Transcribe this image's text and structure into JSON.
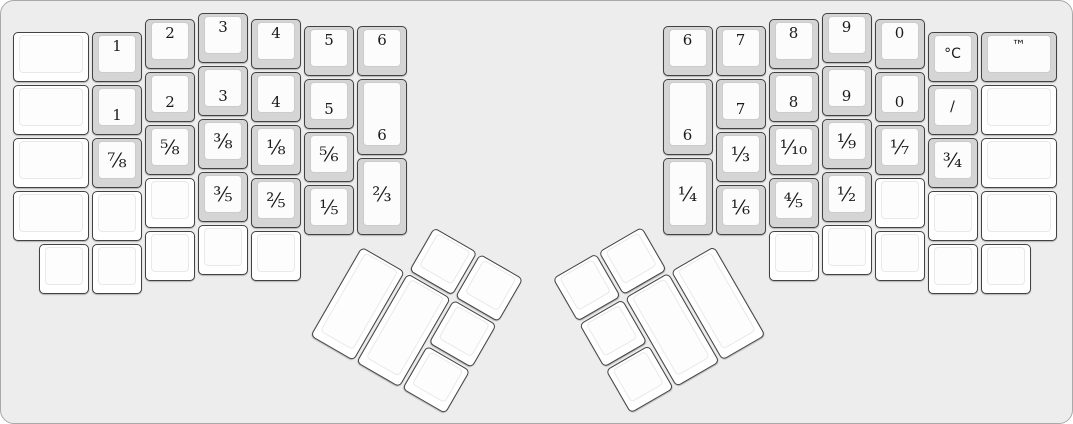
{
  "board": {
    "width_px": 1073,
    "height_px": 424,
    "unit_px": 53,
    "background_color": "#ededed",
    "outline_color": "#a9a9a9"
  },
  "key_style": {
    "labeled_base_color": "#d5d5d5",
    "blank_base_color": "#ffffff",
    "cap_top_color": "#fcfcfc",
    "key_outline_color": "#424242",
    "legend_color": "#1a1a1a"
  },
  "left_half": {
    "origin_px": [
      10,
      10
    ],
    "main_keys": [
      {
        "label": "",
        "x": 0,
        "y": 0.375,
        "w": 1.5,
        "h": 1,
        "pos": "c"
      },
      {
        "label": "",
        "x": 0,
        "y": 1.375,
        "w": 1.5,
        "h": 1,
        "pos": "c"
      },
      {
        "label": "",
        "x": 0,
        "y": 2.375,
        "w": 1.5,
        "h": 1,
        "pos": "c"
      },
      {
        "label": "",
        "x": 0,
        "y": 3.375,
        "w": 1.5,
        "h": 1,
        "pos": "c"
      },
      {
        "label": "",
        "x": 0.5,
        "y": 4.375,
        "w": 1,
        "h": 1,
        "pos": "c"
      },
      {
        "label": "1",
        "x": 1.5,
        "y": 0.375,
        "w": 1,
        "h": 1,
        "pos": "t"
      },
      {
        "label": "1",
        "x": 1.5,
        "y": 1.375,
        "w": 1,
        "h": 1,
        "pos": "b"
      },
      {
        "label": "⅞",
        "x": 1.5,
        "y": 2.375,
        "w": 1,
        "h": 1,
        "pos": "c"
      },
      {
        "label": "",
        "x": 1.5,
        "y": 3.375,
        "w": 1,
        "h": 1,
        "pos": "c"
      },
      {
        "label": "",
        "x": 1.5,
        "y": 4.375,
        "w": 1,
        "h": 1,
        "pos": "c"
      },
      {
        "label": "2",
        "x": 2.5,
        "y": 0.125,
        "w": 1,
        "h": 1,
        "pos": "t"
      },
      {
        "label": "2",
        "x": 2.5,
        "y": 1.125,
        "w": 1,
        "h": 1,
        "pos": "b"
      },
      {
        "label": "⅝",
        "x": 2.5,
        "y": 2.125,
        "w": 1,
        "h": 1,
        "pos": "c"
      },
      {
        "label": "",
        "x": 2.5,
        "y": 3.125,
        "w": 1,
        "h": 1,
        "pos": "c"
      },
      {
        "label": "",
        "x": 2.5,
        "y": 4.125,
        "w": 1,
        "h": 1,
        "pos": "c"
      },
      {
        "label": "3",
        "x": 3.5,
        "y": 0,
        "w": 1,
        "h": 1,
        "pos": "t"
      },
      {
        "label": "3",
        "x": 3.5,
        "y": 1,
        "w": 1,
        "h": 1,
        "pos": "b"
      },
      {
        "label": "⅜",
        "x": 3.5,
        "y": 2,
        "w": 1,
        "h": 1,
        "pos": "c"
      },
      {
        "label": "⅗",
        "x": 3.5,
        "y": 3,
        "w": 1,
        "h": 1,
        "pos": "c"
      },
      {
        "label": "",
        "x": 3.5,
        "y": 4,
        "w": 1,
        "h": 1,
        "pos": "c"
      },
      {
        "label": "4",
        "x": 4.5,
        "y": 0.125,
        "w": 1,
        "h": 1,
        "pos": "t"
      },
      {
        "label": "4",
        "x": 4.5,
        "y": 1.125,
        "w": 1,
        "h": 1,
        "pos": "b"
      },
      {
        "label": "⅛",
        "x": 4.5,
        "y": 2.125,
        "w": 1,
        "h": 1,
        "pos": "c"
      },
      {
        "label": "⅖",
        "x": 4.5,
        "y": 3.125,
        "w": 1,
        "h": 1,
        "pos": "c"
      },
      {
        "label": "",
        "x": 4.5,
        "y": 4.125,
        "w": 1,
        "h": 1,
        "pos": "c"
      },
      {
        "label": "5",
        "x": 5.5,
        "y": 0.25,
        "w": 1,
        "h": 1,
        "pos": "t"
      },
      {
        "label": "5",
        "x": 5.5,
        "y": 1.25,
        "w": 1,
        "h": 1,
        "pos": "b"
      },
      {
        "label": "⅚",
        "x": 5.5,
        "y": 2.25,
        "w": 1,
        "h": 1,
        "pos": "c"
      },
      {
        "label": "⅕",
        "x": 5.5,
        "y": 3.25,
        "w": 1,
        "h": 1,
        "pos": "c"
      },
      {
        "label": "6",
        "x": 6.5,
        "y": 0.25,
        "w": 1,
        "h": 1,
        "pos": "t"
      },
      {
        "label": "6",
        "x": 6.5,
        "y": 1.25,
        "w": 1,
        "h": 1.5,
        "pos": "b"
      },
      {
        "label": "⅔",
        "x": 6.5,
        "y": 2.75,
        "w": 1,
        "h": 1.5,
        "pos": "c"
      }
    ],
    "thumb_cluster": {
      "rotation_deg": 30,
      "center_x_u": 6.6,
      "center_y_u": 4.4,
      "keys": [
        {
          "label": "",
          "x": 1,
          "y": -1,
          "w": 1,
          "h": 1,
          "pos": "c"
        },
        {
          "label": "",
          "x": 2,
          "y": -1,
          "w": 1,
          "h": 1,
          "pos": "c"
        },
        {
          "label": "",
          "x": 0,
          "y": 0,
          "w": 1,
          "h": 2,
          "pos": "c"
        },
        {
          "label": "",
          "x": 1,
          "y": 0,
          "w": 1,
          "h": 2,
          "pos": "c"
        },
        {
          "label": "",
          "x": 2,
          "y": 0,
          "w": 1,
          "h": 1,
          "pos": "c"
        },
        {
          "label": "",
          "x": 2,
          "y": 1,
          "w": 1,
          "h": 1,
          "pos": "c"
        }
      ]
    }
  },
  "right_half": {
    "origin_px": [
      660,
      10
    ],
    "main_keys": [
      {
        "label": "6",
        "x": 0,
        "y": 0.25,
        "w": 1,
        "h": 1,
        "pos": "t"
      },
      {
        "label": "6",
        "x": 0,
        "y": 1.25,
        "w": 1,
        "h": 1.5,
        "pos": "b"
      },
      {
        "label": "¼",
        "x": 0,
        "y": 2.75,
        "w": 1,
        "h": 1.5,
        "pos": "c"
      },
      {
        "label": "7",
        "x": 1,
        "y": 0.25,
        "w": 1,
        "h": 1,
        "pos": "t"
      },
      {
        "label": "7",
        "x": 1,
        "y": 1.25,
        "w": 1,
        "h": 1,
        "pos": "b"
      },
      {
        "label": "⅓",
        "x": 1,
        "y": 2.25,
        "w": 1,
        "h": 1,
        "pos": "c"
      },
      {
        "label": "⅙",
        "x": 1,
        "y": 3.25,
        "w": 1,
        "h": 1,
        "pos": "c"
      },
      {
        "label": "8",
        "x": 2,
        "y": 0.125,
        "w": 1,
        "h": 1,
        "pos": "t"
      },
      {
        "label": "8",
        "x": 2,
        "y": 1.125,
        "w": 1,
        "h": 1,
        "pos": "b"
      },
      {
        "label": "⅒",
        "x": 2,
        "y": 2.125,
        "w": 1,
        "h": 1,
        "pos": "c"
      },
      {
        "label": "⅘",
        "x": 2,
        "y": 3.125,
        "w": 1,
        "h": 1,
        "pos": "c"
      },
      {
        "label": "",
        "x": 2,
        "y": 4.125,
        "w": 1,
        "h": 1,
        "pos": "c"
      },
      {
        "label": "9",
        "x": 3,
        "y": 0,
        "w": 1,
        "h": 1,
        "pos": "t"
      },
      {
        "label": "9",
        "x": 3,
        "y": 1,
        "w": 1,
        "h": 1,
        "pos": "b"
      },
      {
        "label": "⅑",
        "x": 3,
        "y": 2,
        "w": 1,
        "h": 1,
        "pos": "c"
      },
      {
        "label": "½",
        "x": 3,
        "y": 3,
        "w": 1,
        "h": 1,
        "pos": "c"
      },
      {
        "label": "",
        "x": 3,
        "y": 4,
        "w": 1,
        "h": 1,
        "pos": "c"
      },
      {
        "label": "0",
        "x": 4,
        "y": 0.125,
        "w": 1,
        "h": 1,
        "pos": "t"
      },
      {
        "label": "0",
        "x": 4,
        "y": 1.125,
        "w": 1,
        "h": 1,
        "pos": "b"
      },
      {
        "label": "⅐",
        "x": 4,
        "y": 2.125,
        "w": 1,
        "h": 1,
        "pos": "c"
      },
      {
        "label": "",
        "x": 4,
        "y": 3.125,
        "w": 1,
        "h": 1,
        "pos": "c"
      },
      {
        "label": "",
        "x": 4,
        "y": 4.125,
        "w": 1,
        "h": 1,
        "pos": "c"
      },
      {
        "label": "°C",
        "x": 5,
        "y": 0.375,
        "w": 1,
        "h": 1,
        "pos": "c"
      },
      {
        "label": "/",
        "x": 5,
        "y": 1.375,
        "w": 1,
        "h": 1,
        "pos": "c"
      },
      {
        "label": "¾",
        "x": 5,
        "y": 2.375,
        "w": 1,
        "h": 1,
        "pos": "c"
      },
      {
        "label": "",
        "x": 5,
        "y": 3.375,
        "w": 1,
        "h": 1,
        "pos": "c"
      },
      {
        "label": "",
        "x": 5,
        "y": 4.375,
        "w": 1,
        "h": 1,
        "pos": "c"
      },
      {
        "label": "™",
        "x": 6,
        "y": 0.375,
        "w": 1.5,
        "h": 1,
        "pos": "t"
      },
      {
        "label": "",
        "x": 6,
        "y": 1.375,
        "w": 1.5,
        "h": 1,
        "pos": "c"
      },
      {
        "label": "",
        "x": 6,
        "y": 2.375,
        "w": 1.5,
        "h": 1,
        "pos": "c"
      },
      {
        "label": "",
        "x": 6,
        "y": 3.375,
        "w": 1.5,
        "h": 1,
        "pos": "c"
      },
      {
        "label": "",
        "x": 6,
        "y": 4.375,
        "w": 1,
        "h": 1,
        "pos": "c"
      }
    ],
    "thumb_cluster": {
      "rotation_deg": -30,
      "center_x_u": 1.0,
      "center_y_u": 4.4,
      "keys": [
        {
          "label": "",
          "x": -3,
          "y": -1,
          "w": 1,
          "h": 1,
          "pos": "c"
        },
        {
          "label": "",
          "x": -2,
          "y": -1,
          "w": 1,
          "h": 1,
          "pos": "c"
        },
        {
          "label": "",
          "x": -3,
          "y": 0,
          "w": 1,
          "h": 1,
          "pos": "c"
        },
        {
          "label": "",
          "x": -2,
          "y": 0,
          "w": 1,
          "h": 2,
          "pos": "c"
        },
        {
          "label": "",
          "x": -1,
          "y": 0,
          "w": 1,
          "h": 2,
          "pos": "c"
        },
        {
          "label": "",
          "x": -3,
          "y": 1,
          "w": 1,
          "h": 1,
          "pos": "c"
        }
      ]
    }
  }
}
